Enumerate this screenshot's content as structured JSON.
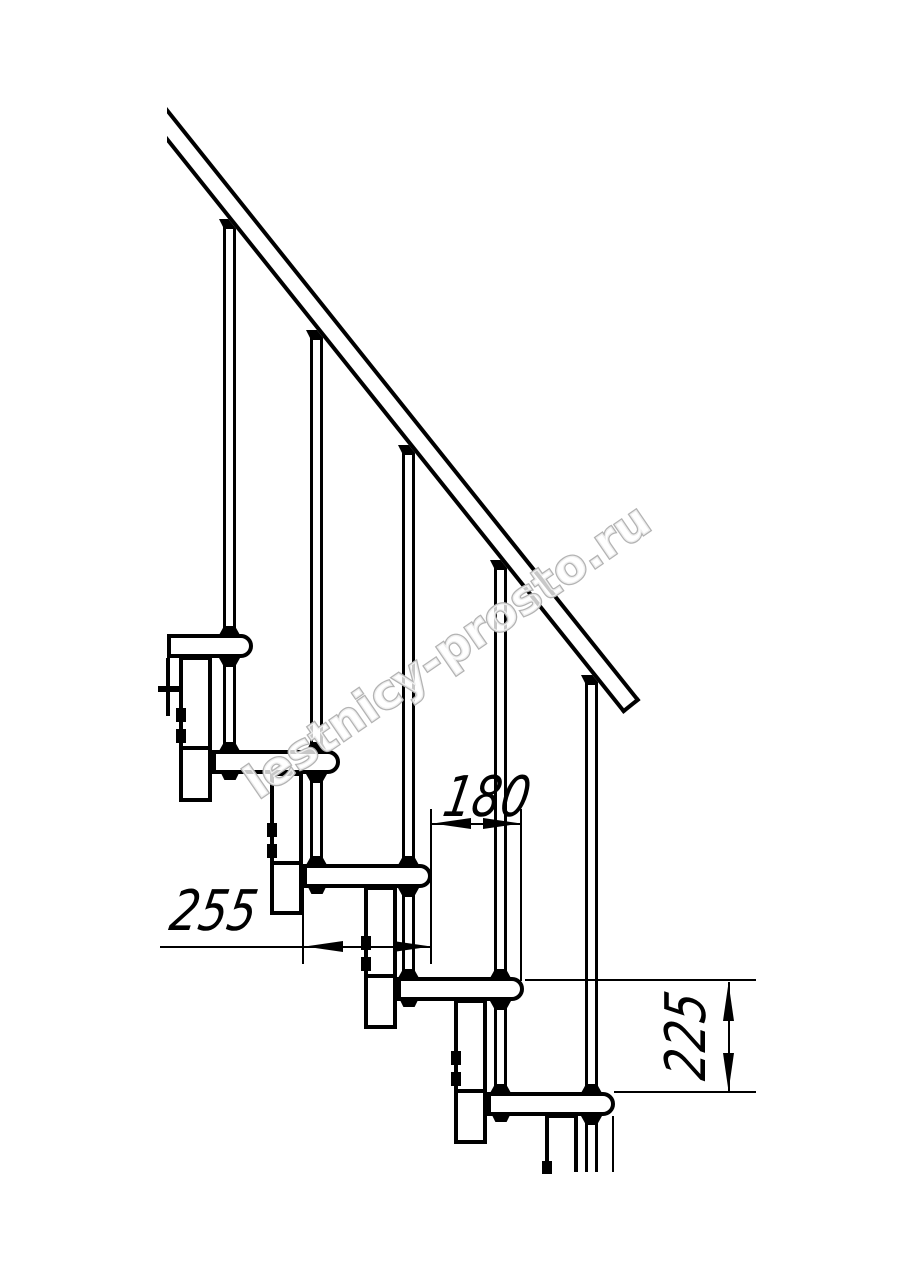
{
  "drawing": {
    "type": "staircase-side-view-fragment",
    "dimensions": {
      "tread_depth": "255",
      "run": "180",
      "rise": "225"
    },
    "watermark": "lestnicy-prosto.ru",
    "structure": {
      "steps": 5,
      "balusters": 5,
      "support_columns": 5,
      "handrail": 1
    },
    "colors": {
      "line": "#000000",
      "background": "#ffffff",
      "watermark_outline": "#b3b3b3"
    }
  }
}
